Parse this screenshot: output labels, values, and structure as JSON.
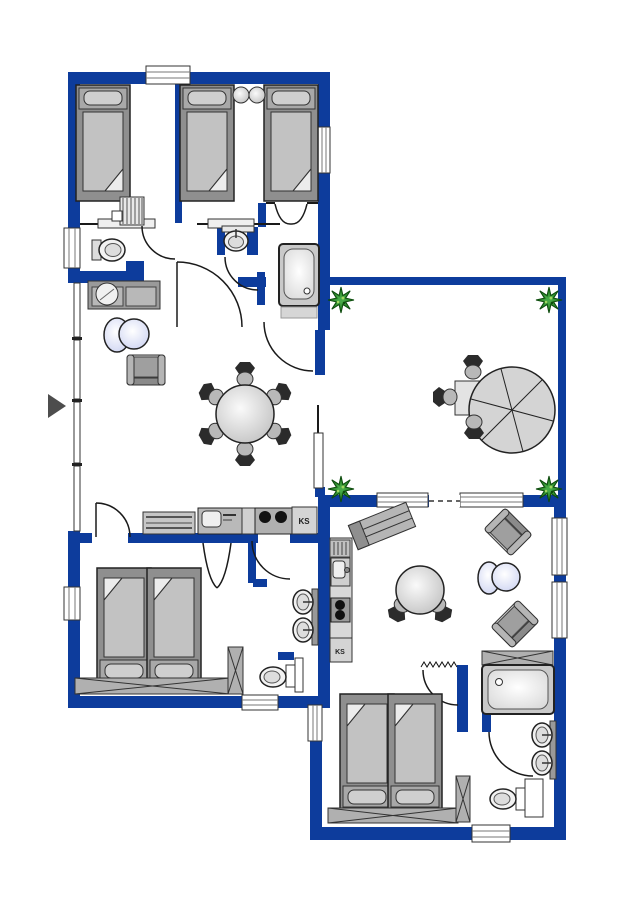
{
  "title": "holiday-apartment-floorplan",
  "colors": {
    "wall": "#0d3c9c",
    "outline": "#1a1a1a",
    "plant": "#2e8b2e",
    "background": "#ffffff",
    "furniture_gray": "#c2c2c2",
    "furniture_dark": "#8f8f8f"
  },
  "labels": {
    "fridge_left": "KS",
    "fridge_right": "KS"
  },
  "entrance": {
    "marker": "arrow-right"
  },
  "inventory": {
    "top_bedroom_left": [
      "single-bed",
      "radiator",
      "shelf"
    ],
    "top_bedroom_right": [
      "single-bed",
      "single-bed",
      "stool",
      "stool"
    ],
    "wc_top": [
      "toilet",
      "window"
    ],
    "bath_top": [
      "washbasin",
      "bathtub",
      "bath-mat"
    ],
    "living_room": [
      "sofa",
      "round-pillow",
      "coffee-table",
      "armchair",
      "dining-table",
      "six-chairs",
      "glass-front"
    ],
    "kitchen_left": [
      "dishwasher",
      "sink",
      "stove-2-burners",
      "fridge-KS"
    ],
    "bedroom_bottom_left": [
      "double-bed",
      "wardrobe",
      "wardrobe"
    ],
    "bath_bottom_left": [
      "double-washbasin",
      "toilet"
    ],
    "terrace": [
      "plant",
      "plant",
      "plant",
      "plant",
      "parasol",
      "table",
      "chair",
      "chair",
      "chair"
    ],
    "right_apartment_living": [
      "sideboard",
      "kitchen-strip",
      "fridge-KS",
      "round-table",
      "chair",
      "chair",
      "armchair",
      "armchair",
      "coffee-table"
    ],
    "right_apartment_sleeping": [
      "double-bed",
      "wardrobe",
      "wardrobe"
    ],
    "bath_right": [
      "bathtub",
      "curtain",
      "double-washbasin",
      "toilet",
      "wardrobe"
    ]
  }
}
